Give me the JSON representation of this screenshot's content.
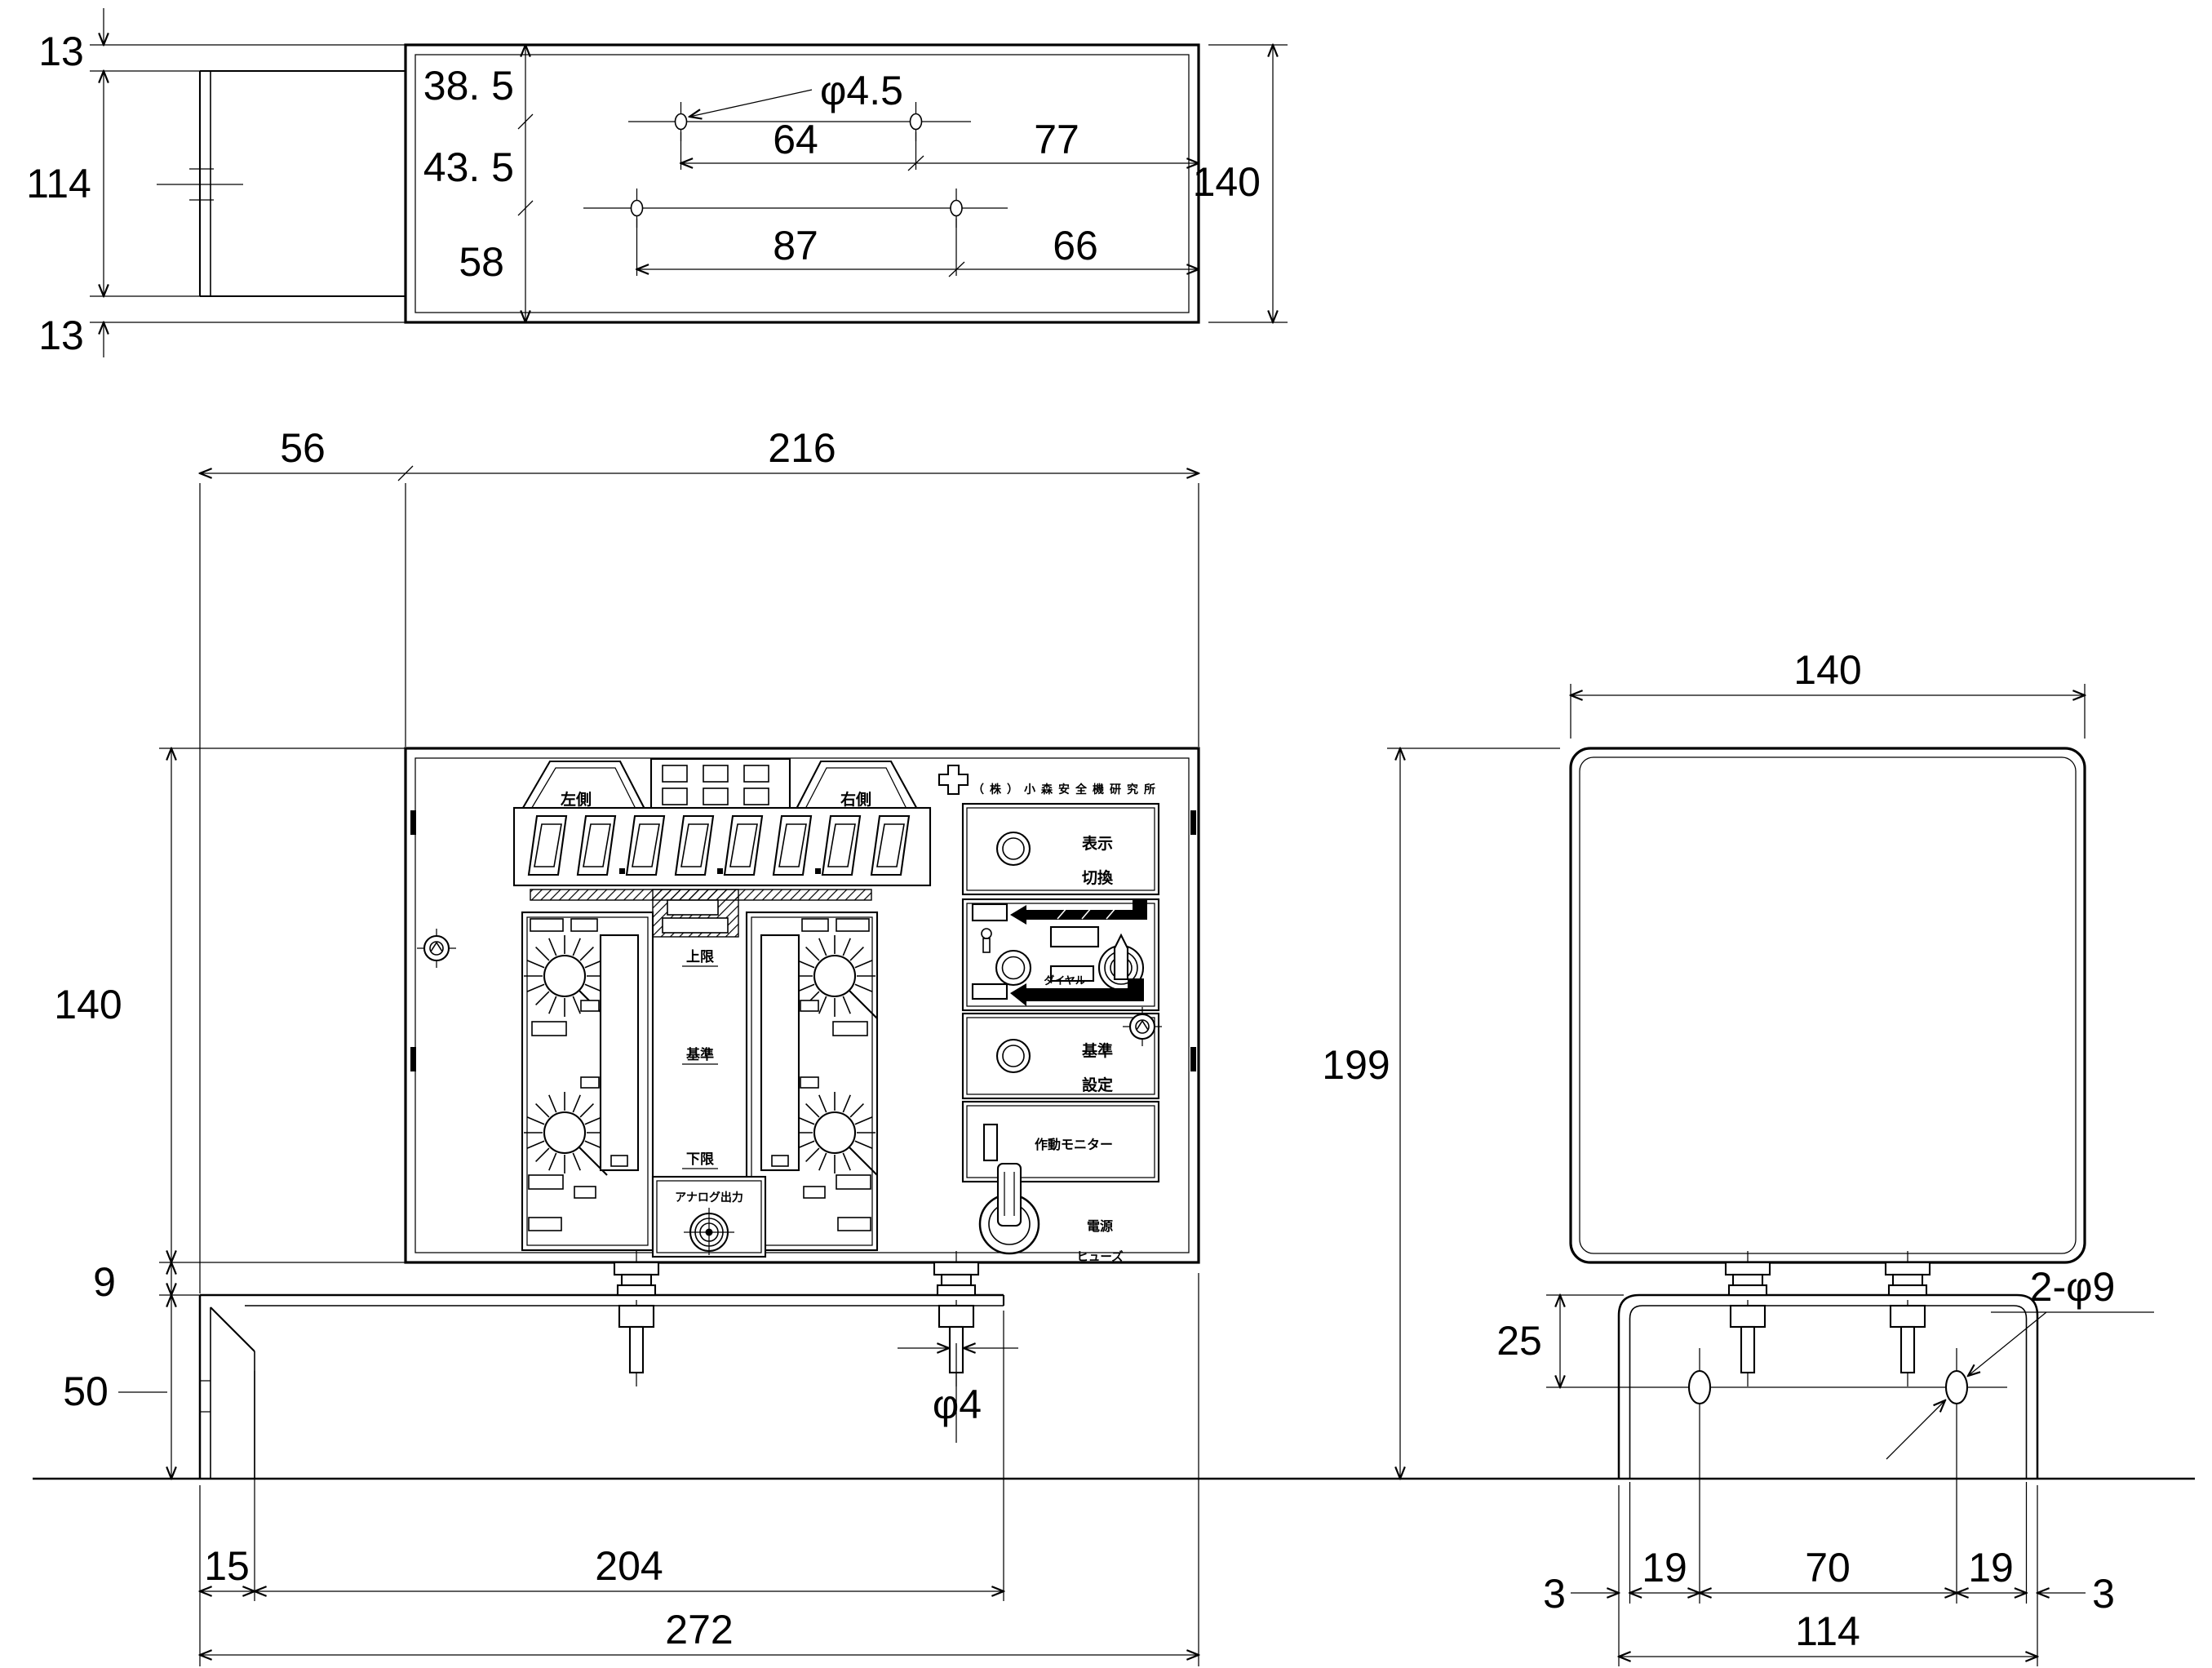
{
  "top": {
    "d13a": "13",
    "d114": "114",
    "d13b": "13",
    "d385": "38. 5",
    "d435": "43. 5",
    "d58": "58",
    "d64": "64",
    "d77": "77",
    "d87": "87",
    "d66": "66",
    "d140": "140",
    "hole_callout": "φ4.5"
  },
  "front": {
    "d56": "56",
    "d216": "216",
    "d140": "140",
    "d9": "9",
    "d50": "50",
    "d15": "15",
    "d204": "204",
    "d272": "272",
    "bolt_callout": "φ4"
  },
  "side": {
    "d140": "140",
    "d199": "199",
    "d25": "25",
    "hole_callout": "2-φ9",
    "d3a": "3",
    "d19a": "19",
    "d70": "70",
    "d19b": "19",
    "d3b": "3",
    "d114": "114"
  },
  "panel": {
    "maker": "（株）小森安全機研究所",
    "display_left": "左側",
    "display_right": "右側",
    "upper_limit": "上限",
    "reference": "基準",
    "lower_limit": "下限",
    "analog_output": "アナログ出力",
    "disp_switch_1": "表示",
    "disp_switch_2": "切換",
    "ref_set_1": "基準",
    "ref_set_2": "設定",
    "operation_monitor": "作動モニター",
    "dial": "ダイヤル",
    "power": "電源",
    "fuse": "ヒューズ"
  }
}
